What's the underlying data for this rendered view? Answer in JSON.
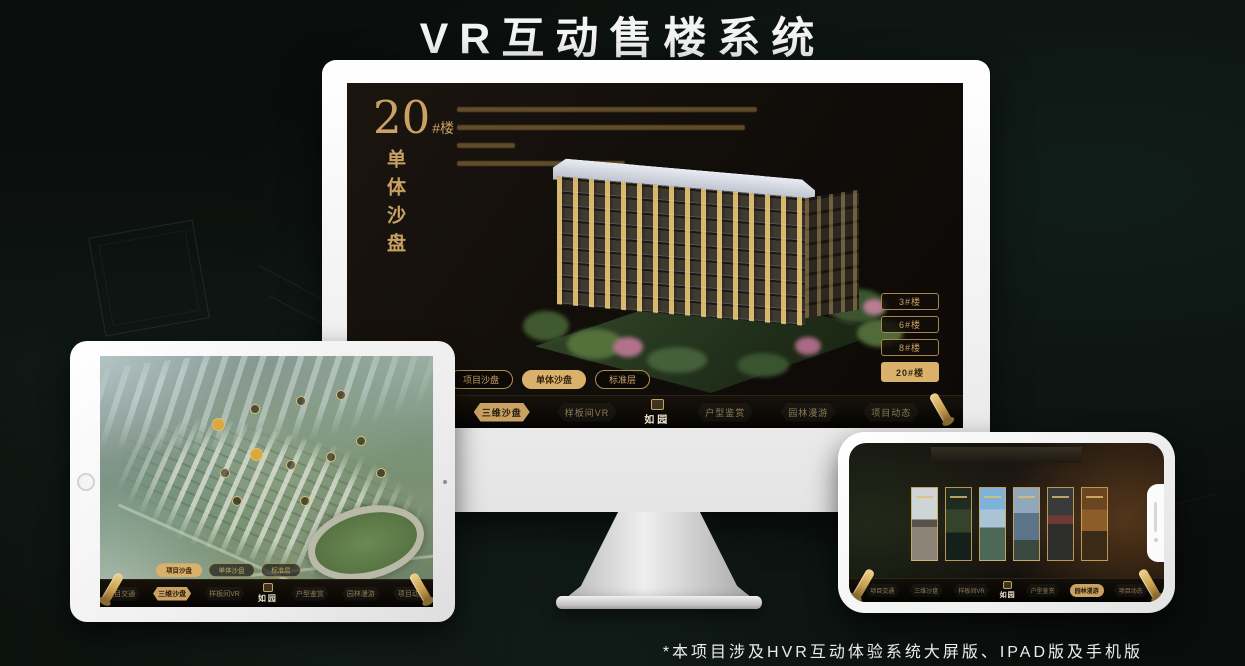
{
  "page": {
    "title": "VR互动售楼系统",
    "footnote": "*本项目涉及HVR互动体验系统大屏版、IPAD版及手机版"
  },
  "colors": {
    "accent_gold": "#c9a263",
    "gold_fill": "#d9b16b",
    "monitor_screen_bg": "#14100c"
  },
  "monitor": {
    "headline": {
      "number": "20",
      "suffix": "#楼",
      "vertical_label": "单体沙盘"
    },
    "floor_buttons": [
      {
        "label": "3#楼",
        "selected": false
      },
      {
        "label": "6#楼",
        "selected": false
      },
      {
        "label": "8#楼",
        "selected": false
      },
      {
        "label": "20#楼",
        "selected": true
      }
    ],
    "tabs": [
      {
        "label": "项目沙盘",
        "selected": false
      },
      {
        "label": "单体沙盘",
        "selected": true
      },
      {
        "label": "标准层",
        "selected": false
      }
    ],
    "nav": {
      "items_left": [
        "项目交通",
        "三维沙盘",
        "样板间VR"
      ],
      "items_right": [
        "户型鉴赏",
        "园林漫游",
        "项目动态"
      ],
      "active_item": "三维沙盘",
      "logo": "如园"
    }
  },
  "tablet": {
    "tabs": [
      {
        "label": "项目沙盘",
        "selected": true
      },
      {
        "label": "单体沙盘",
        "selected": false
      },
      {
        "label": "标准层",
        "selected": false
      }
    ],
    "nav": {
      "items_left": [
        "项目交通",
        "三维沙盘",
        "样板间VR"
      ],
      "items_right": [
        "户型鉴赏",
        "园林漫游",
        "项目动态"
      ],
      "active_item": "三维沙盘",
      "logo": "如园"
    }
  },
  "phone": {
    "nav": {
      "items_left": [
        "项目交通",
        "三维沙盘",
        "样板间VR"
      ],
      "items_right": [
        "户型鉴赏",
        "园林漫游",
        "项目动态"
      ],
      "active_item": "园林漫游",
      "logo": "如园"
    }
  }
}
